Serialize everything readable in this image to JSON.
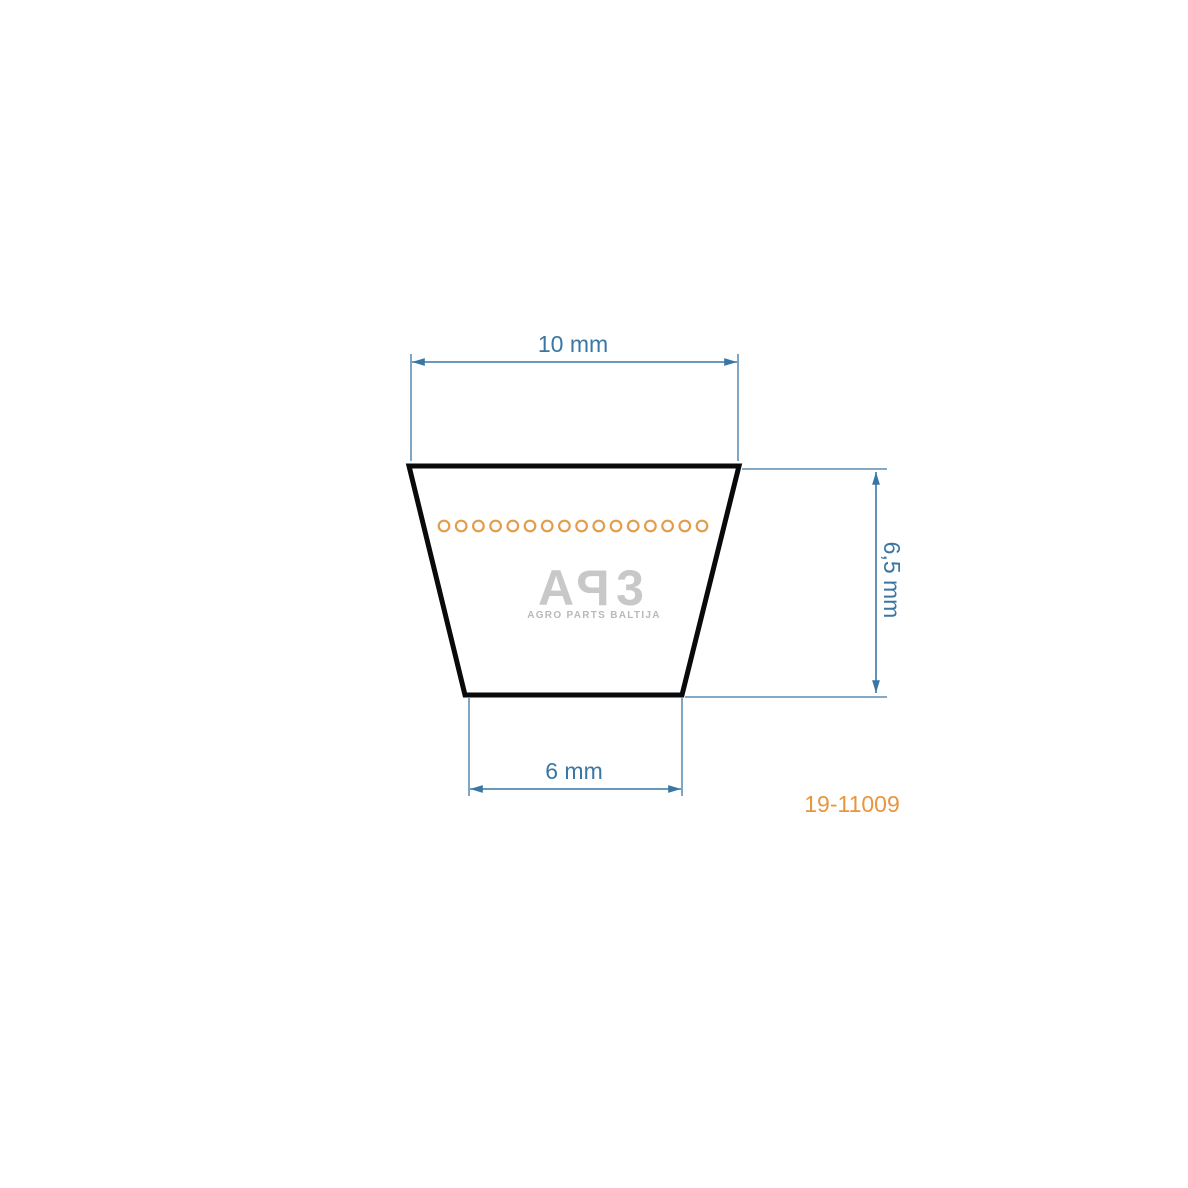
{
  "diagram": {
    "title": "v-belt-cross-section-drawing",
    "part_number": "19-11009",
    "dimensions": {
      "top_width": "10 mm",
      "height": "6,5 mm",
      "bottom_width": "6 mm"
    },
    "cord_dots": {
      "count": 16,
      "color": "#e39c4a"
    },
    "colors": {
      "dimension_blue": "#3a76a4",
      "outline_black": "#0a0a0a",
      "part_number_orange": "#e8953c",
      "watermark_gray": "#c8c8c8"
    }
  },
  "watermark": {
    "logo_text": "APB",
    "logo": [
      "A",
      "P",
      "3"
    ],
    "subtitle": "AGRO PARTS BALTIJA"
  }
}
